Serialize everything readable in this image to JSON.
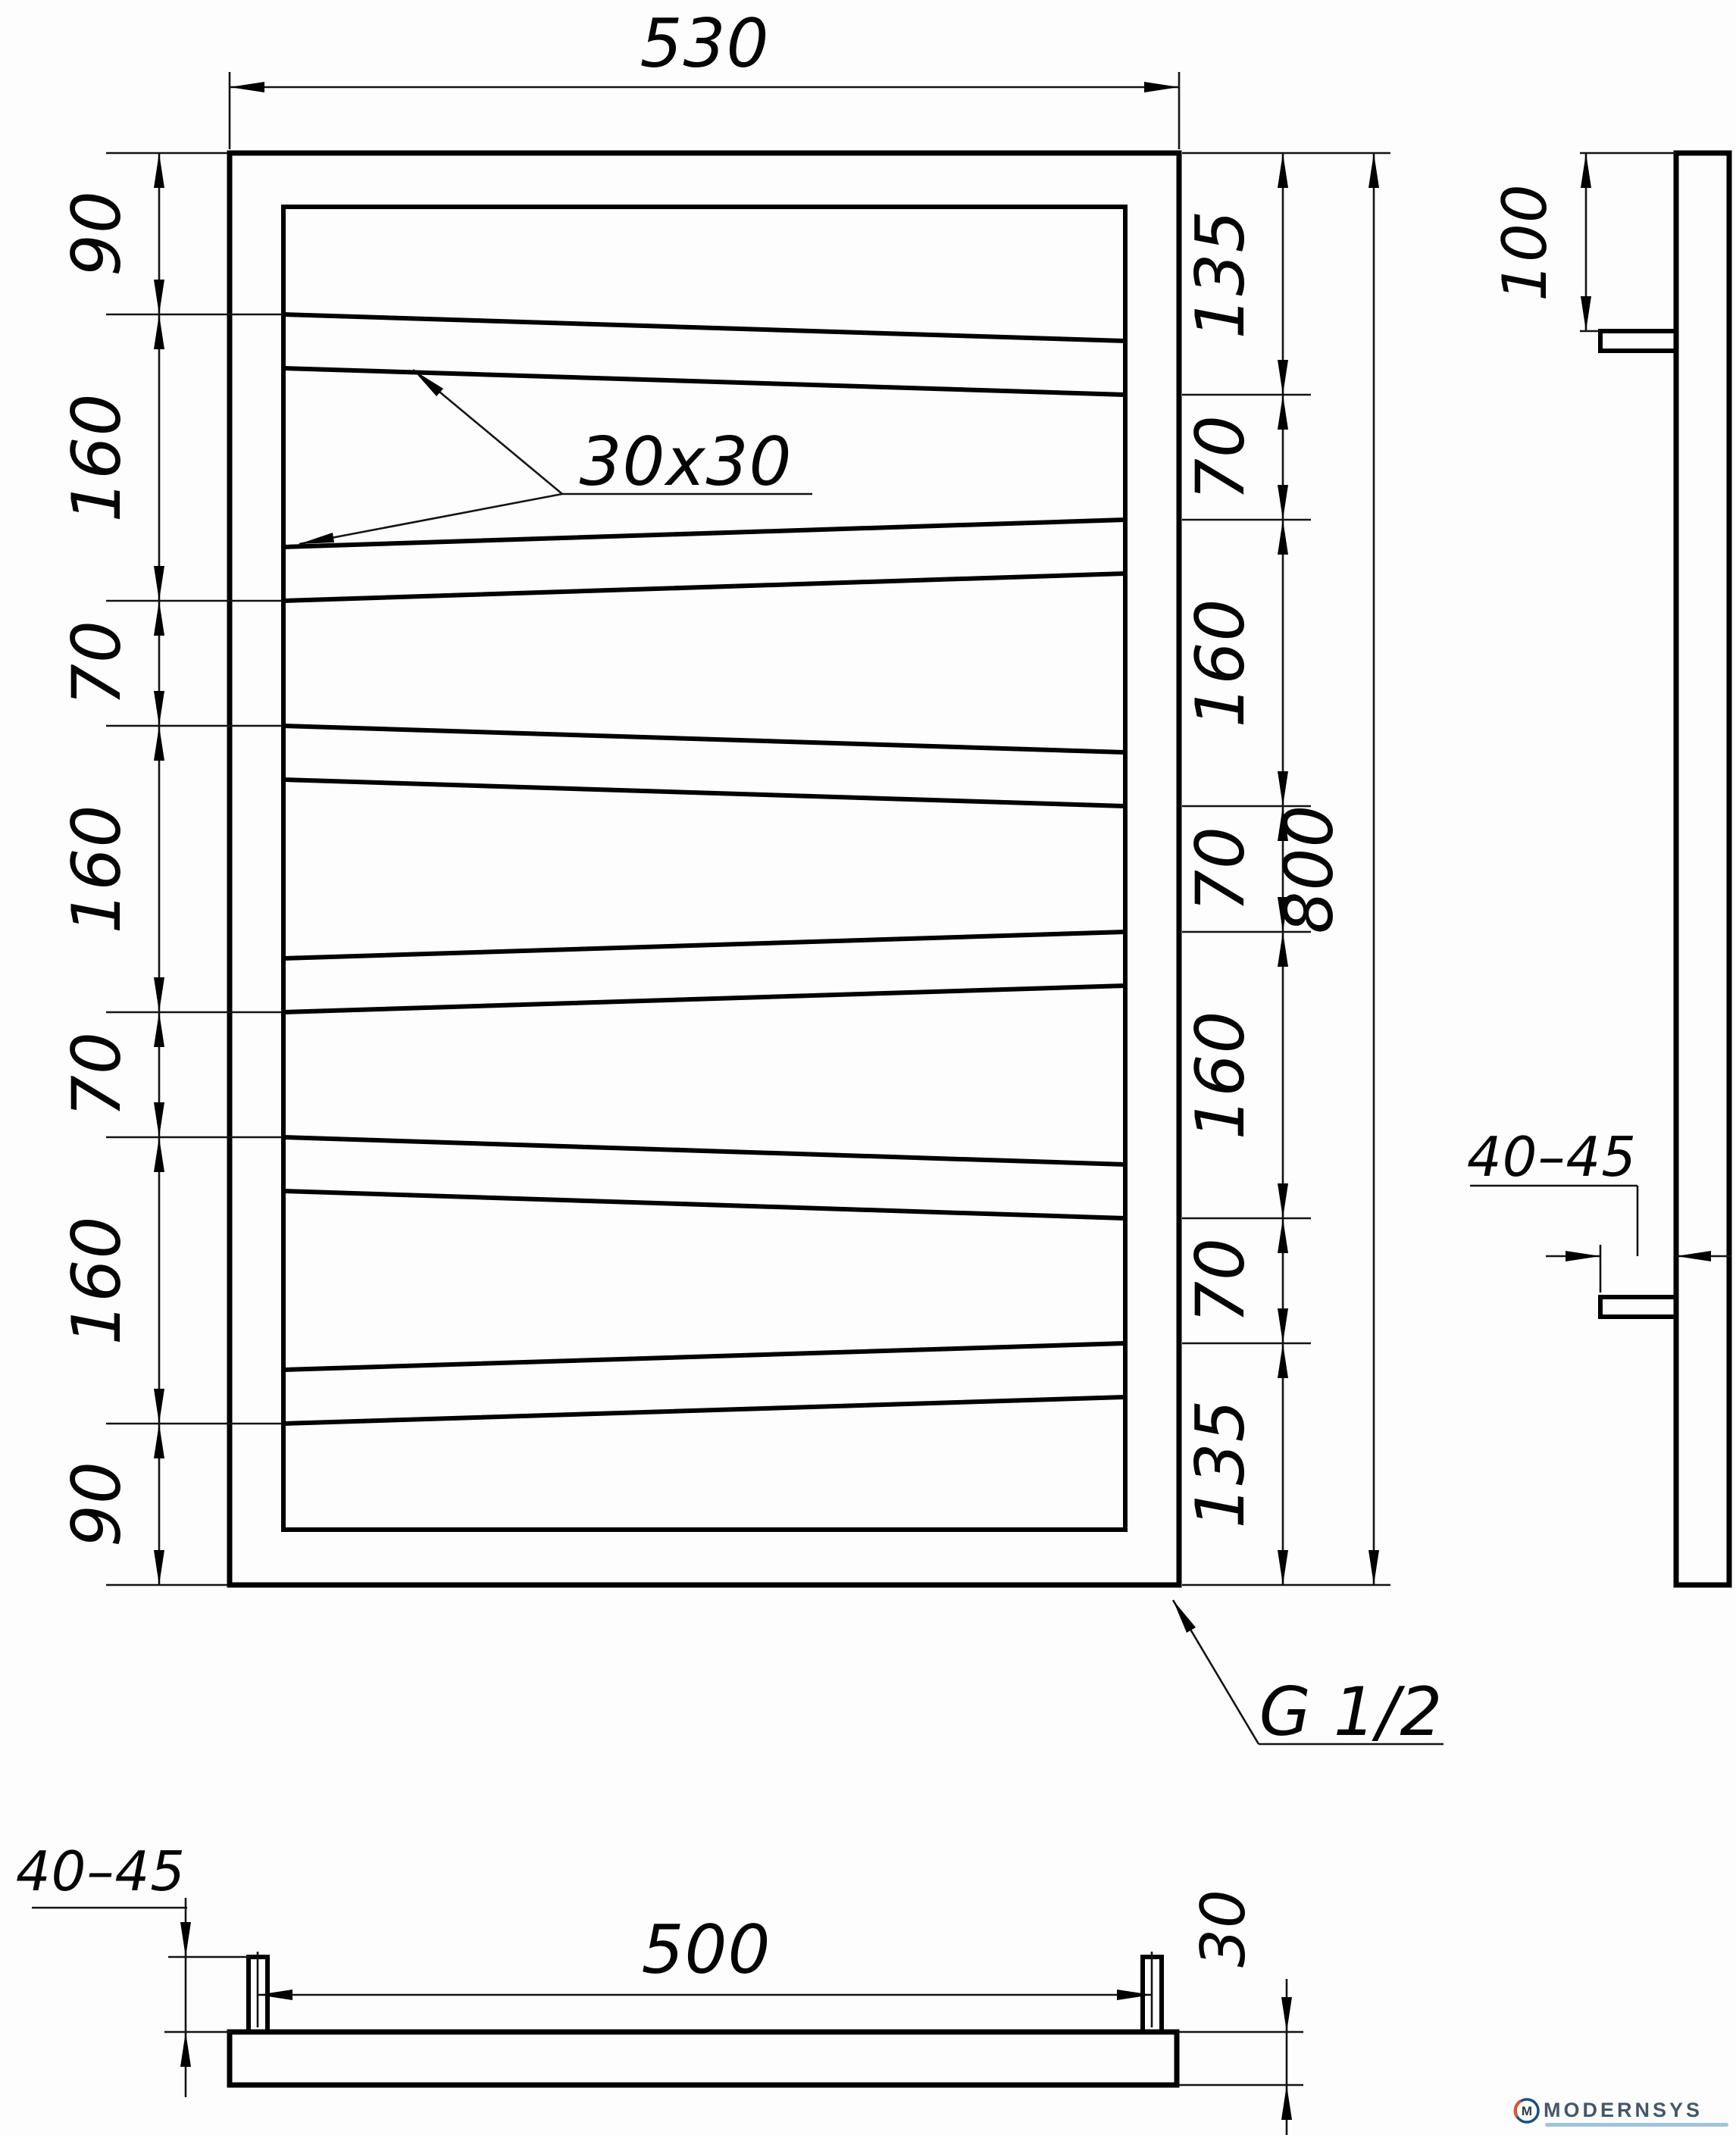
{
  "drawing": {
    "front_view": {
      "width_label": "530",
      "height_label": "800",
      "left_chain": [
        "90",
        "160",
        "70",
        "160",
        "70",
        "160",
        "90"
      ],
      "right_chain": [
        "135",
        "70",
        "160",
        "70",
        "160",
        "70",
        "135"
      ],
      "tube_section_label": "30x30",
      "thread_label": "G 1/2"
    },
    "side_view": {
      "top_offset_label": "100",
      "bracket_depth_label": "40–45"
    },
    "bottom_view": {
      "bracket_span_label": "500",
      "tube_depth_label": "30",
      "bracket_height_label": "40–45"
    },
    "logo": {
      "brand": "MODERNSYS",
      "monogram": "M"
    }
  },
  "colors": {
    "line": "#000000",
    "logo_blue": "#44576b",
    "logo_ring": "#1a4e8a",
    "logo_accent": "#e2532e",
    "logo_tagline": "#9fc3dd"
  }
}
